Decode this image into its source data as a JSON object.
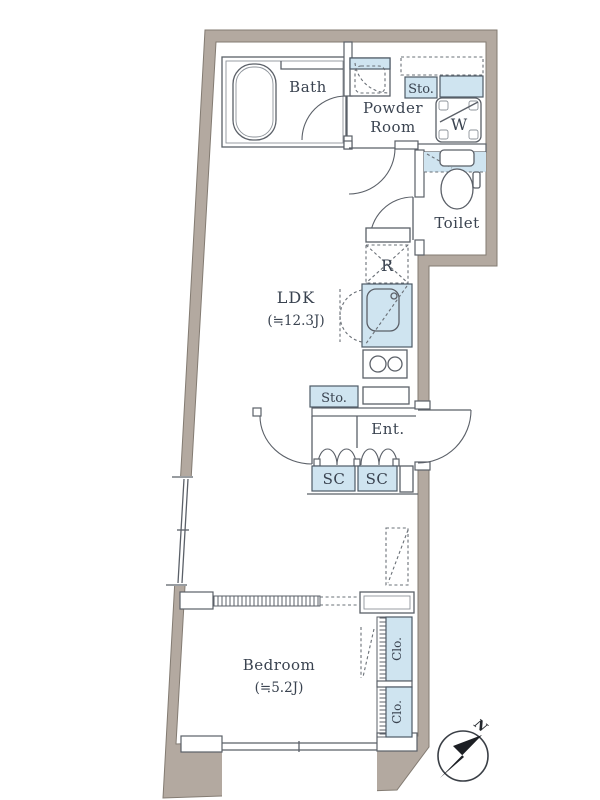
{
  "floorplan": {
    "rooms": {
      "bath": {
        "name": "Bath"
      },
      "powder_room": {
        "name_line1": "Powder",
        "name_line2": "Room"
      },
      "toilet": {
        "name": "Toilet"
      },
      "ldk": {
        "name": "LDK",
        "area": "(≒12.3J)"
      },
      "entrance": {
        "name": "Ent."
      },
      "bedroom": {
        "name": "Bedroom",
        "area": "(≒5.2J)"
      }
    },
    "closets": {
      "storage_powder": "Sto.",
      "storage_hall": "Sto.",
      "shoe_closet_1": "SC",
      "shoe_closet_2": "SC",
      "closet_1": "Clo.",
      "closet_2": "Clo."
    },
    "appliances": {
      "washing_machine": "W",
      "refrigerator": "R"
    },
    "compass_north": "N",
    "colors": {
      "wall": "#b3a9a0",
      "fixture_blue": "#cfe4f0",
      "line": "#5b6068",
      "text": "#3a4350",
      "background": "#ffffff"
    }
  }
}
